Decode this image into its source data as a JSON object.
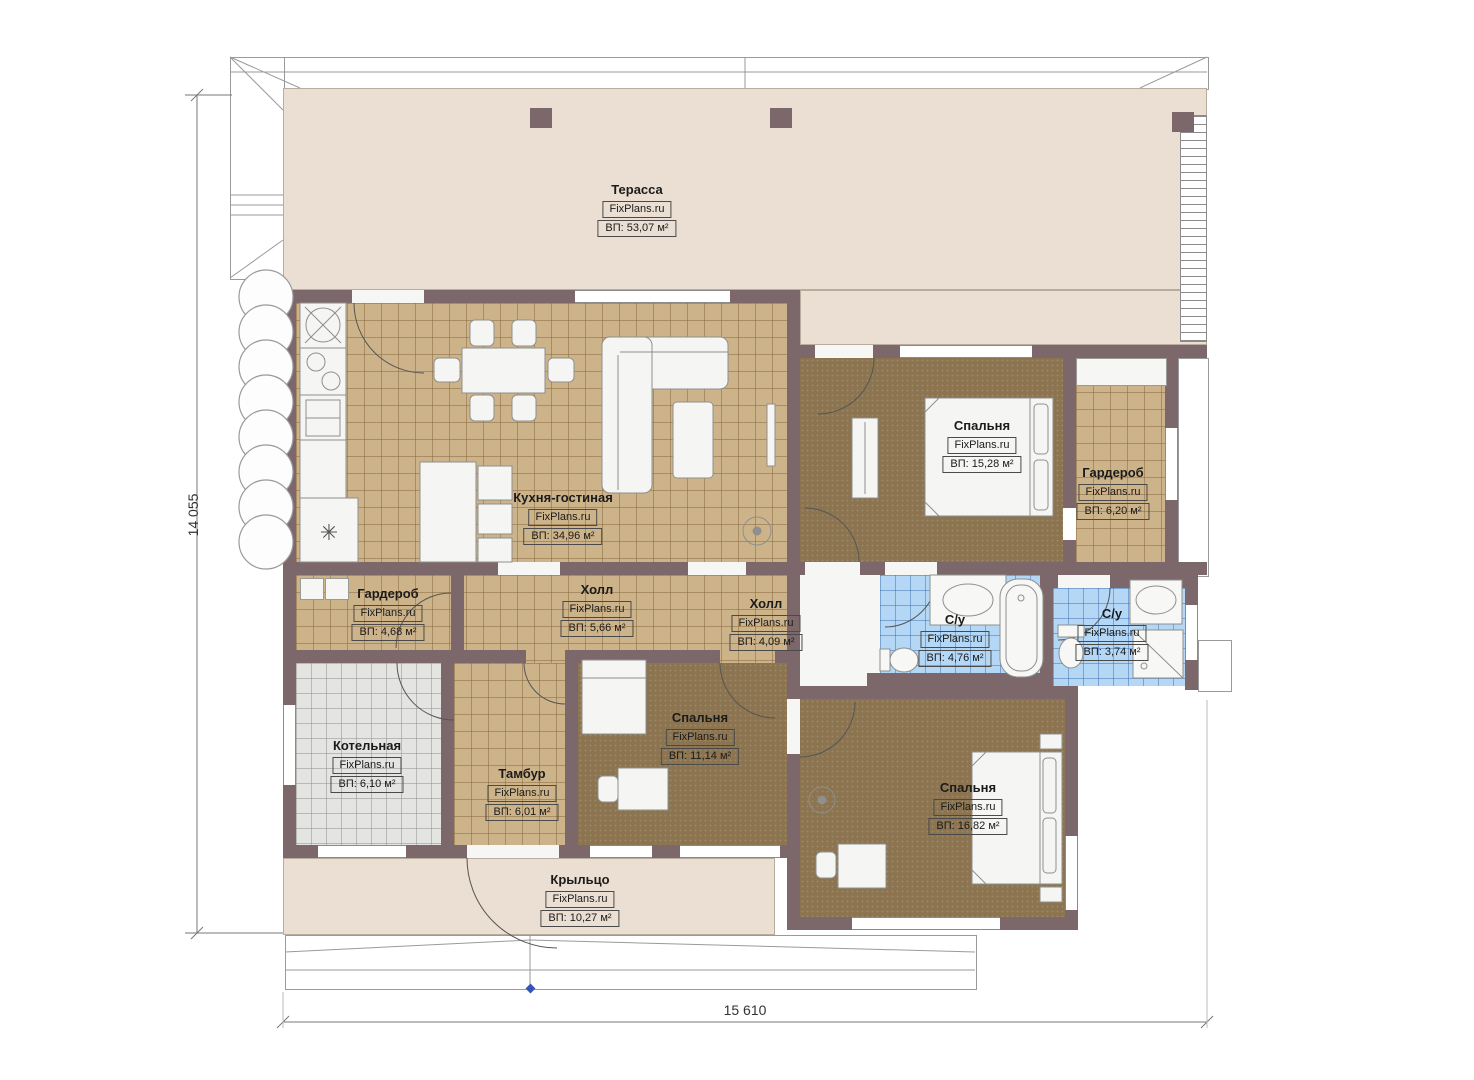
{
  "meta": {
    "site": "FixPlans.ru"
  },
  "dimensions": {
    "height_label": "14 055",
    "width_label": "15 610"
  },
  "colors": {
    "wall": "#7c686b",
    "terrace_floor": "#eadfd2",
    "tile_floor": "#cdb38a",
    "carpet_floor": "#8b744f",
    "bath_floor": "#b4d7f5",
    "boiler_floor": "#e4e4e2",
    "level_marker": "#3355bb"
  },
  "rooms": [
    {
      "id": "terrace",
      "name": "Терасса",
      "area": "ВП: 53,07 м²"
    },
    {
      "id": "kitchen",
      "name": "Кухня-гостиная",
      "area": "ВП: 34,96 м²"
    },
    {
      "id": "bedroom1",
      "name": "Спальня",
      "area": "ВП: 15,28 м²"
    },
    {
      "id": "wardrobe1",
      "name": "Гардероб",
      "area": "ВП: 6,20 м²"
    },
    {
      "id": "wardrobe2",
      "name": "Гардероб",
      "area": "ВП: 4,68 м²"
    },
    {
      "id": "hall1",
      "name": "Холл",
      "area": "ВП: 5,66 м²"
    },
    {
      "id": "hall2",
      "name": "Холл",
      "area": "ВП: 4,09 м²"
    },
    {
      "id": "bath1",
      "name": "С/у",
      "area": "ВП: 4,76 м²"
    },
    {
      "id": "bath2",
      "name": "С/у",
      "area": "ВП: 3,74 м²"
    },
    {
      "id": "boiler",
      "name": "Котельная",
      "area": "ВП: 6,10 м²"
    },
    {
      "id": "tambour",
      "name": "Тамбур",
      "area": "ВП: 6,01 м²"
    },
    {
      "id": "bedroom2",
      "name": "Спальня",
      "area": "ВП: 11,14 м²"
    },
    {
      "id": "bedroom3",
      "name": "Спальня",
      "area": "ВП: 16,82 м²"
    },
    {
      "id": "porch",
      "name": "Крыльцо",
      "area": "ВП: 10,27 м²"
    }
  ]
}
